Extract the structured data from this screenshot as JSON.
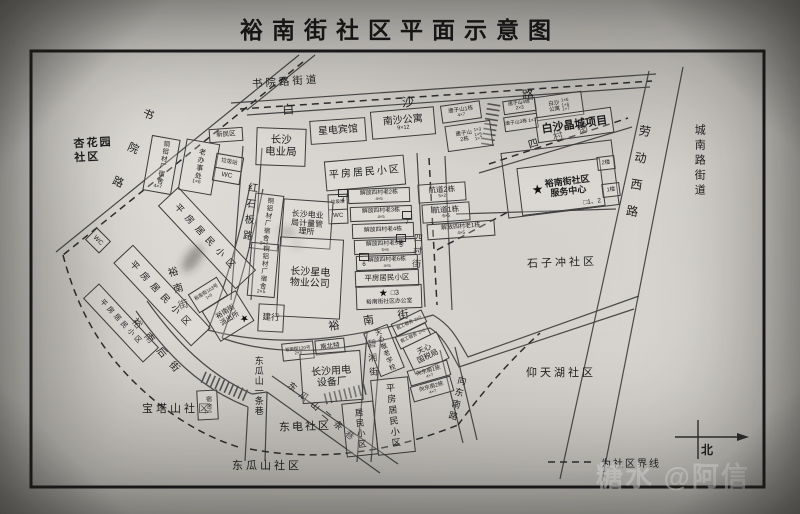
{
  "title": "裕南街社区平面示意图",
  "watermark": "糖水 @阿信",
  "legend": {
    "boundary": "为社区界线"
  },
  "compass": {
    "north": "北"
  },
  "symbols": {
    "star": "★"
  },
  "districts": {
    "shuyuan_street": "书院路街道",
    "xinghuayuan": "杏花园\n社区",
    "chengnan_street": "城南路街道",
    "shizichong": "石子冲社区",
    "yangtianhu": "仰天湖社区",
    "baotashan": "宝塔山社区",
    "dongdian": "东电社区",
    "dongguashan": "东瓜山社区"
  },
  "roads": {
    "baisha": "白沙路",
    "shuyuan": "书院路",
    "laodongxi": "劳动西路",
    "hongshiban": "红石板路",
    "yunan_w": "裕南街",
    "yunan_c": "裕南街",
    "yunanhou": "裕南后街",
    "sicun_h": "四村街",
    "sicun_v": "四村街",
    "dongguashan_1": "东瓜山一条巷",
    "dongguashan_2": "东瓜山二条巷",
    "bixiang": "碧湘街",
    "xiangdongnan": "向东南路"
  },
  "buildings": {
    "xinminqu": {
      "label": "新民区"
    },
    "tonglv_a": {
      "label": "铜铝材厂宿舍",
      "sub": "4×7"
    },
    "laobanshichu": {
      "label": "老办事处",
      "sub": "1×6"
    },
    "laji_a": {
      "label": "垃圾站",
      "sub": "WC"
    },
    "dianyeju": {
      "label": "长沙\n电业局"
    },
    "xingdian_hotel": {
      "label": "星电宾馆"
    },
    "nansha": {
      "label": "南沙公寓",
      "sub": "9×12"
    },
    "tangzishan1": {
      "label": "唐子山1栋",
      "sub": "4×7"
    },
    "tangzishan2": {
      "label": "唐子山\n2栋",
      "sub": "1×3\n1×5\n1×7"
    },
    "tangzishan3": {
      "label": "唐子山3栋 1×7"
    },
    "tangzishan4": {
      "label": "唐子山4栋 2×3"
    },
    "baisha_apartment": {
      "label": "白沙\n公寓",
      "sub": "1×6\n1×6\n1×7"
    },
    "baisha_jingcheng": {
      "label": "白沙晶城项目"
    },
    "pingfang_top": {
      "label": "平房居民小区"
    },
    "hangdao2": {
      "label": "航道2栋",
      "sub": "5×2"
    },
    "hangdao1": {
      "label": "航道1栋",
      "sub": "6×5"
    },
    "jiefang1": {
      "label": "解放四村老1栋",
      "sub": "4×5"
    },
    "service_center": {
      "label": "裕南街社区\n服务中心",
      "marker": "□1、2",
      "floor2": "2楼",
      "floor1": "1楼"
    },
    "jiefang2": {
      "label": "解放四村老2栋",
      "sub": "4×5"
    },
    "jiefang3": {
      "label": "解放四村老3栋",
      "sub": "4×5"
    },
    "jiefang4": {
      "label": "解放四村老4栋"
    },
    "jiefang5": {
      "label": "解放四村老5栋",
      "sub": "5×6"
    },
    "jiefang6": {
      "label": "解放四村老6栋",
      "sub": "4×5"
    },
    "pingfang_mid": {
      "label": "平房居民小区"
    },
    "community_office": {
      "marker": "□3",
      "label": "裕南街社区办公室"
    },
    "laji_b": {
      "label": "垃圾站",
      "sub": "WC"
    },
    "tonglv_b": {
      "label": "铜铝材厂宿舍",
      "sub": "3×7"
    },
    "jiliangsuo": {
      "label": "长沙电业\n局计量管\n理所"
    },
    "tonglv_c": {
      "label": "铜铝材厂宿舍",
      "sub": "2×5"
    },
    "wuye": {
      "label": "长沙星电\n物业公司"
    },
    "jianhang": {
      "label": "建行"
    },
    "yunan103": {
      "label": "裕南街103号",
      "sub": "1×5"
    },
    "police": {
      "label": "裕南街\n派出所"
    },
    "pingfang_l1": {
      "label": "平房居民小区"
    },
    "pingfang_l2": {
      "label": "平房居民小区"
    },
    "pingfang_l3": {
      "label": "平房居民小区"
    },
    "wc_left": {
      "label": "WC"
    },
    "sushe": {
      "label": "宿舍",
      "sub": "1×5"
    },
    "yunan120": {
      "label": "裕南街120号",
      "sub": "2×3"
    },
    "nanbeite": {
      "label": "南北特"
    },
    "shebeichang": {
      "label": "长沙用电\n设备厂"
    },
    "jinglao_school": {
      "label": "天心敬老学校"
    },
    "jungong_a": {
      "label": "君工宿舍",
      "sub": "2×2"
    },
    "jungong_b": {
      "label": "君工宿舍",
      "sub": "2×2"
    },
    "guoshuiju": {
      "label": "天心\n国税局"
    },
    "xiangdongnan1": {
      "label": "向东南1栋",
      "sub": "4×7"
    },
    "xiangdongnan2": {
      "label": "向东南2栋",
      "sub": "4×7"
    },
    "pingfang_bottom": {
      "label": "平房居民小区"
    },
    "jumin": {
      "label": "居民小区"
    }
  },
  "markers": {
    "m4": "4",
    "m5": "5",
    "m6": "6",
    "m7": "7"
  }
}
